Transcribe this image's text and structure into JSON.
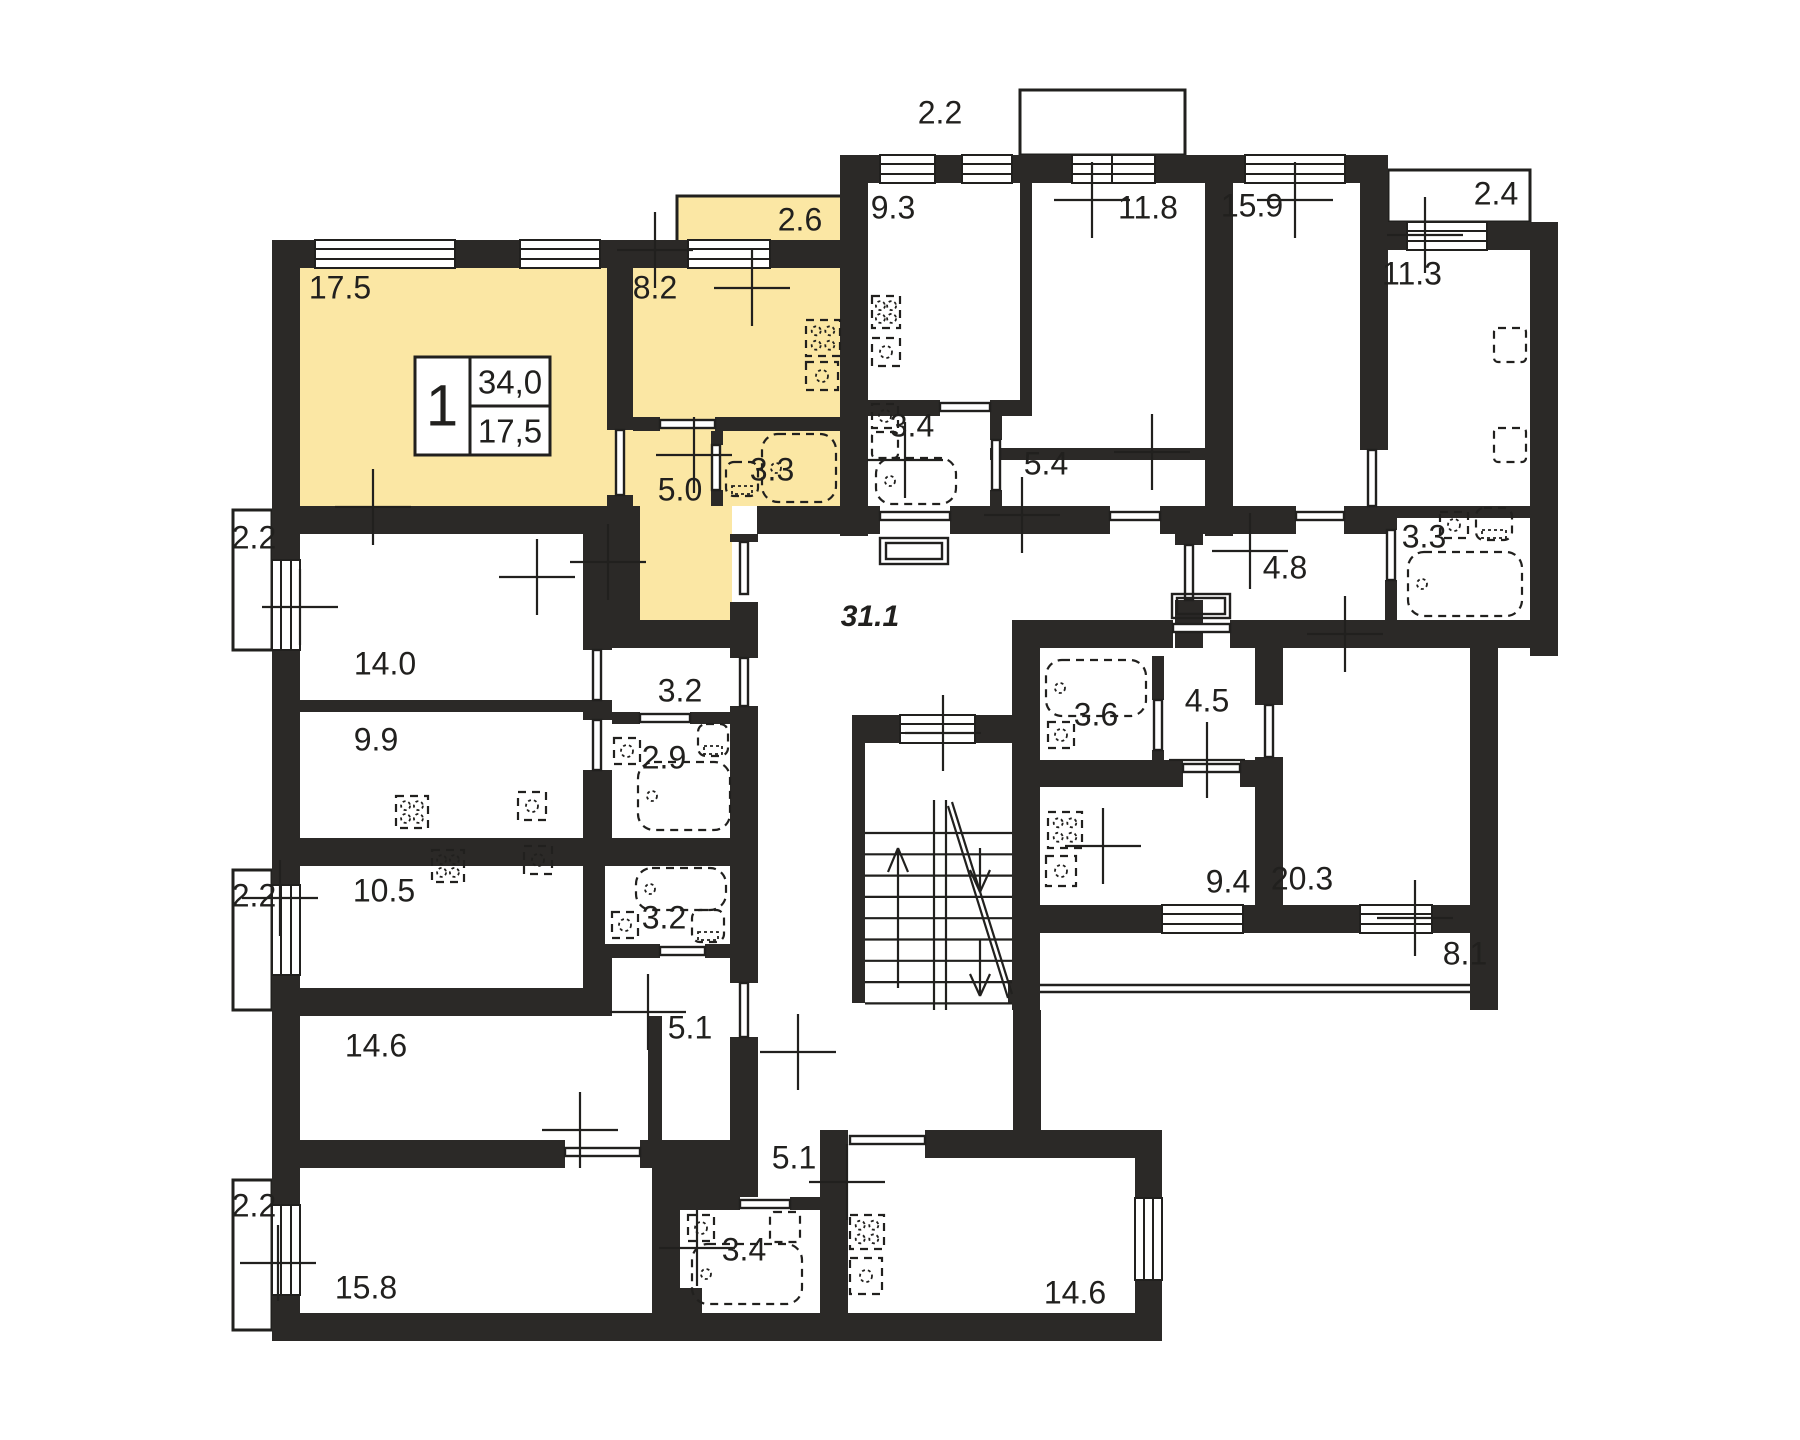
{
  "plan": {
    "colors": {
      "highlight": "#fbe7a4",
      "wall": "#2b2927",
      "line": "#21201e",
      "text": "#21201e"
    },
    "stamp": {
      "rooms": "1",
      "total_area": "34,0",
      "living_area": "17,5"
    },
    "rooms": [
      {
        "label": "2.2",
        "x": 940,
        "y": 115
      },
      {
        "label": "9.3",
        "x": 893,
        "y": 210
      },
      {
        "label": "11.8",
        "x": 1148,
        "y": 210
      },
      {
        "label": "15.9",
        "x": 1252,
        "y": 208
      },
      {
        "label": "2.4",
        "x": 1496,
        "y": 196
      },
      {
        "label": "11.3",
        "x": 1412,
        "y": 276
      },
      {
        "label": "2.6",
        "x": 800,
        "y": 222
      },
      {
        "label": "17.5",
        "x": 340,
        "y": 290
      },
      {
        "label": "8.2",
        "x": 655,
        "y": 290
      },
      {
        "label": "3.4",
        "x": 912,
        "y": 428
      },
      {
        "label": "5.4",
        "x": 1046,
        "y": 466
      },
      {
        "label": "3.3",
        "x": 772,
        "y": 472
      },
      {
        "label": "5.0",
        "x": 680,
        "y": 492
      },
      {
        "label": "2.2",
        "x": 254,
        "y": 540
      },
      {
        "label": "4.8",
        "x": 1285,
        "y": 570
      },
      {
        "label": "3.3",
        "x": 1424,
        "y": 539
      },
      {
        "label": "31.1",
        "x": 870,
        "y": 618,
        "italic": true
      },
      {
        "label": "14.0",
        "x": 385,
        "y": 666
      },
      {
        "label": "3.2",
        "x": 680,
        "y": 693
      },
      {
        "label": "9.9",
        "x": 376,
        "y": 742
      },
      {
        "label": "2.9",
        "x": 664,
        "y": 760
      },
      {
        "label": "3.6",
        "x": 1096,
        "y": 717
      },
      {
        "label": "4.5",
        "x": 1207,
        "y": 703
      },
      {
        "label": "2.2",
        "x": 254,
        "y": 898
      },
      {
        "label": "10.5",
        "x": 384,
        "y": 893
      },
      {
        "label": "9.4",
        "x": 1228,
        "y": 884
      },
      {
        "label": "20.3",
        "x": 1302,
        "y": 881
      },
      {
        "label": "3.2",
        "x": 664,
        "y": 920
      },
      {
        "label": "14.6",
        "x": 376,
        "y": 1048
      },
      {
        "label": "8.1",
        "x": 1465,
        "y": 956
      },
      {
        "label": "5.1",
        "x": 690,
        "y": 1030
      },
      {
        "label": "5.1",
        "x": 794,
        "y": 1160
      },
      {
        "label": "2.2",
        "x": 254,
        "y": 1208
      },
      {
        "label": "15.8",
        "x": 366,
        "y": 1290
      },
      {
        "label": "3.4",
        "x": 744,
        "y": 1252
      },
      {
        "label": "14.6",
        "x": 1075,
        "y": 1295
      }
    ]
  }
}
